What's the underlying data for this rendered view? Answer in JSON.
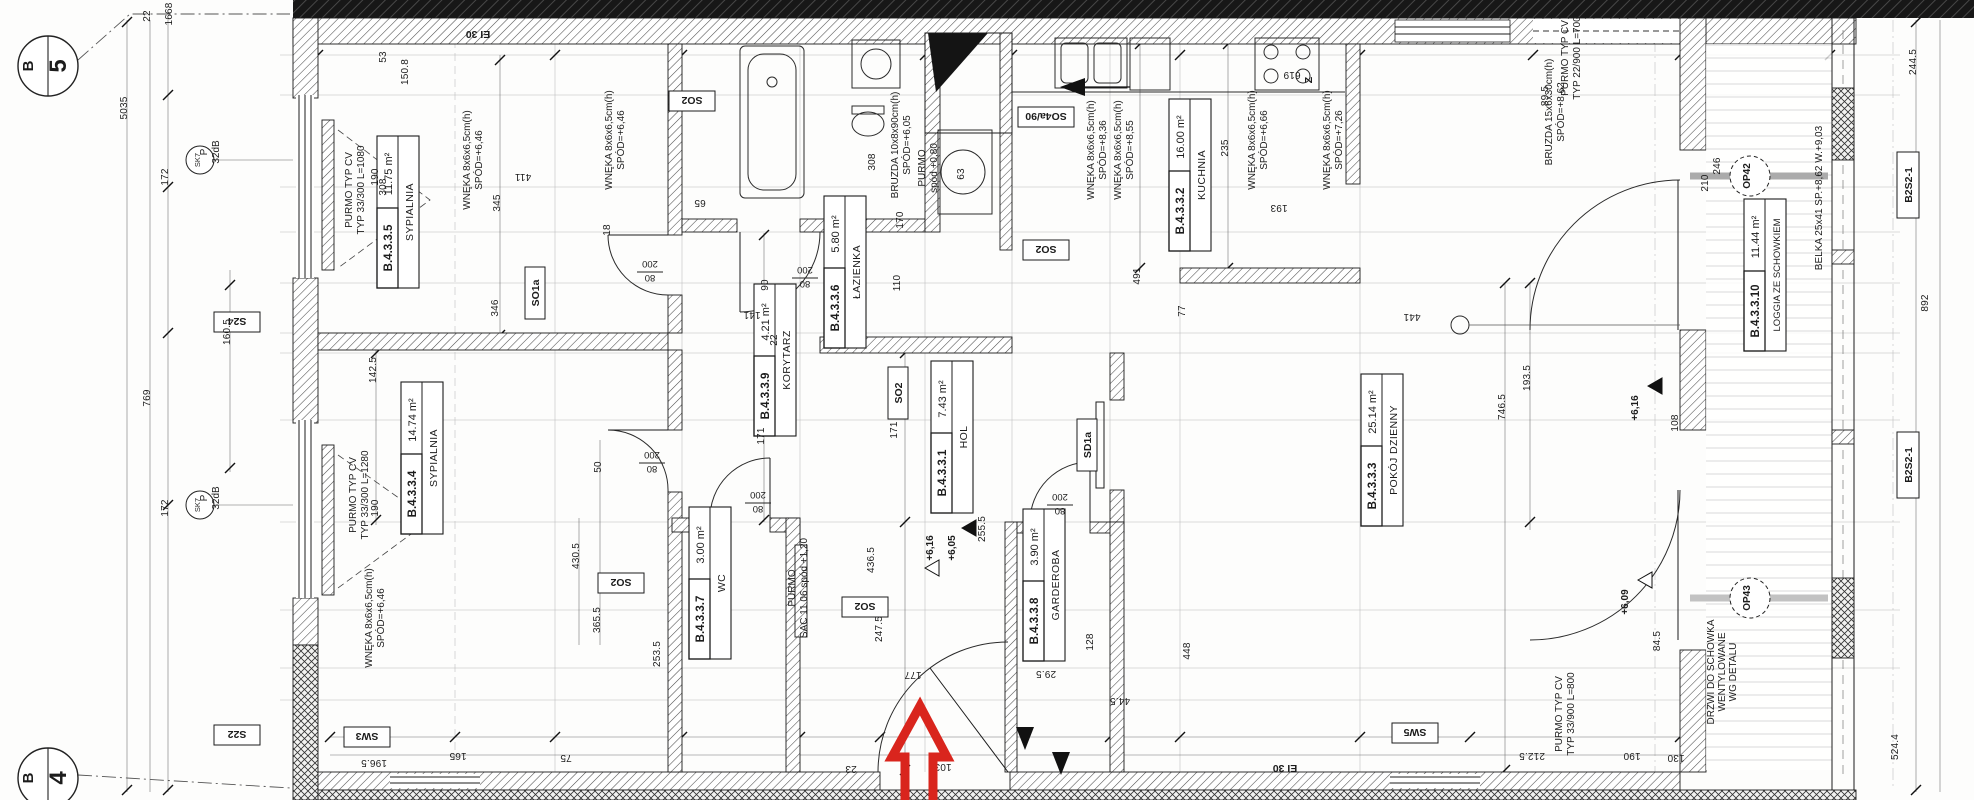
{
  "plan": {
    "rooms": [
      {
        "id": "B.4.3.3.5",
        "name": "SYPIALNIA",
        "area": "11.75 m²"
      },
      {
        "id": "B.4.3.3.4",
        "name": "SYPIALNIA",
        "area": "14.74 m²"
      },
      {
        "id": "B.4.3.3.6",
        "name": "ŁAZIENKA",
        "area": "5.80 m²"
      },
      {
        "id": "B.4.3.3.9",
        "name": "KORYTARZ",
        "area": "4.21 m²"
      },
      {
        "id": "B.4.3.3.1",
        "name": "HOL",
        "area": "7.43 m²"
      },
      {
        "id": "B.4.3.3.7",
        "name": "WC",
        "area": "3.00 m²"
      },
      {
        "id": "B.4.3.3.8",
        "name": "GARDEROBA",
        "area": "3.90 m²"
      },
      {
        "id": "B.4.3.3.2",
        "name": "KUCHNIA",
        "area": "16.00 m²"
      },
      {
        "id": "B.4.3.3.3",
        "name": "POKÓJ DZIENNY",
        "area": "25.14 m²"
      },
      {
        "id": "B.4.3.3.10",
        "name": "LOGGIA ZE SCHOWKIEM",
        "area": "11.44 m²"
      }
    ],
    "grid": {
      "letter_top": "B",
      "num_top": "5",
      "letter_bottom": "B",
      "num_bottom": "4"
    },
    "tags": {
      "s24": "S24",
      "s22": "S22",
      "sw3": "SW3",
      "sw5": "SW5",
      "so1a": "SO1a",
      "sd1a": "SD1a",
      "so2": "SO2",
      "so4a": "SO4a/90",
      "ei30": "EI 30",
      "b2s2": "B2S2-1",
      "op42": "OP42",
      "op43": "OP43",
      "door_w": "80",
      "door_h": "200",
      "z": "Z",
      "sk7": "SK7"
    },
    "levels": {
      "hall_upper": "+6,16",
      "hall_lower": "+6,05",
      "loggia_a": "+6,16",
      "loggia_b": "+6,09"
    },
    "ann": {
      "wneka": "WNĘKA 8x6x6,5cm(h)",
      "spod646": "SPÓD=+6,46",
      "spod836": "SPÓD=+8,36",
      "spod855": "SPÓD=+8,55",
      "spod666": "SPÓD=+6,66",
      "spod726": "SPÓD=+7,26",
      "purmo": "PURMO TYP CV",
      "p1080": "TYP 33/300 L=1080",
      "p1280": "TYP 33/300 L=1280",
      "p700": "TYP 22/900 L=700",
      "p800": "TYP 33/900 L=800",
      "purmo_s": "PURMO",
      "sac": "SAC 11 06 spód +1,20",
      "spod080": "spód +0,80",
      "bruzda1": "BRUZDA 10x8x90cm(h)",
      "bruzda1b": "SPÓD=+6,05",
      "bruzda2": "BRUZDA 15x6x30cm(h)",
      "bruzda2b": "SPÓD=+8,62",
      "belka": "BELKA 25x41  SP.+8,62 W.+9,03",
      "drzwi1": "DRZWI DO SCHOWKA",
      "drzwi2": "WENTYLOWANE",
      "drzwi3": "WG DETALU",
      "p_label": "P",
      "db_label": "32dB"
    },
    "dims": {
      "d0": "22",
      "d1": "1668",
      "d2": "5035",
      "d3": "172",
      "d4": "769",
      "d5": "160.5",
      "d6": "172",
      "d7": "142.5",
      "d8": "190",
      "d9": "190",
      "d10": "53",
      "d11": "308",
      "d12": "150.8",
      "d13": "345",
      "d14": "346",
      "d15": "411",
      "d16": "65",
      "d17": "90",
      "d18": "141",
      "d19": "22",
      "d20": "18",
      "d21": "170",
      "d22": "110",
      "d23": "77",
      "d24": "235",
      "d25": "193",
      "d26": "491",
      "d27": "619",
      "d28": "441",
      "d29": "746.5",
      "d30": "193.5",
      "d31": "210",
      "d32": "246",
      "d33": "430.5",
      "d34": "50",
      "d35": "365.5",
      "d36": "436.5",
      "d37": "171",
      "d38": "171",
      "d39": "177",
      "d40": "103",
      "d41": "23",
      "d42": "253.5",
      "d43": "247.5",
      "d44": "255.5",
      "d45": "448",
      "d46": "128",
      "d47": "29.5",
      "d48": "44.5",
      "d49": "212.5",
      "d50": "190",
      "d51": "130",
      "d52": "196.5",
      "d53": "165",
      "d54": "75",
      "d55": "89.5",
      "d56": "108",
      "d57": "84.5",
      "d58": "244.5",
      "d59": "892",
      "d60": "524.4",
      "d61": "63",
      "d62": "308"
    }
  }
}
